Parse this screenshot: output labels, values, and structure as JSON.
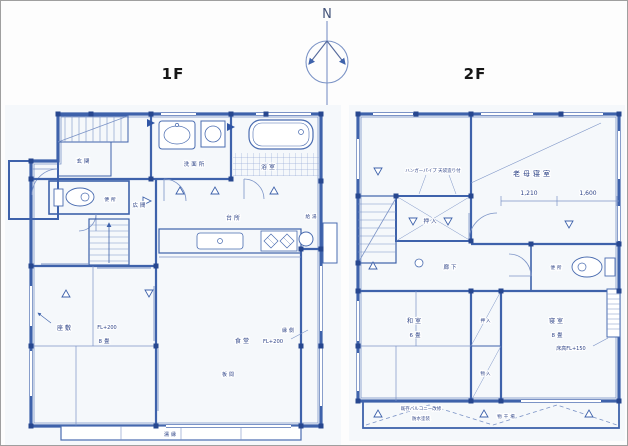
{
  "compass": {
    "north_label": "N"
  },
  "floor1": {
    "title": "1F",
    "labels": {
      "genkan": "玄関",
      "hiroma": "広間",
      "toilet": "便所",
      "washroom": "洗面所",
      "bath": "浴室",
      "kitchen": "台所",
      "dining": "食堂",
      "dining_level": "FL+200",
      "zashiki": "座敷",
      "zashiki_level": "FL+200",
      "zashiki_size": "8畳",
      "itanoma": "板間",
      "engawa": "縁側",
      "nureen": "濡縁",
      "water_heater": "給湯"
    }
  },
  "floor2": {
    "title": "2F",
    "labels": {
      "elder_bedroom": "老母寝室",
      "closet_note": "ハンガーパイプ 天袋造り付",
      "oshiire_top": "押入",
      "corridor": "廊下",
      "toilet": "便所",
      "washitsu": "和室",
      "washitsu_size": "6畳",
      "oshiire_mid": "押入",
      "mono_mid": "物入",
      "bedroom": "寝室",
      "bedroom_size": "8畳",
      "bedroom_level": "床高FL+150",
      "balcony_note1": "既存バルコニー改修",
      "balcony_note2": "防水塗装",
      "monohoshi": "物干場"
    },
    "dimensions": {
      "d1": "1,210",
      "d2": "1,600"
    }
  },
  "colors": {
    "line_blue": "#3e62ab",
    "post_navy": "#27478f",
    "light_blue": "#7b93c6",
    "text_navy": "#2d4387",
    "title_black": "#161616",
    "paper": "#fdfdfd"
  }
}
